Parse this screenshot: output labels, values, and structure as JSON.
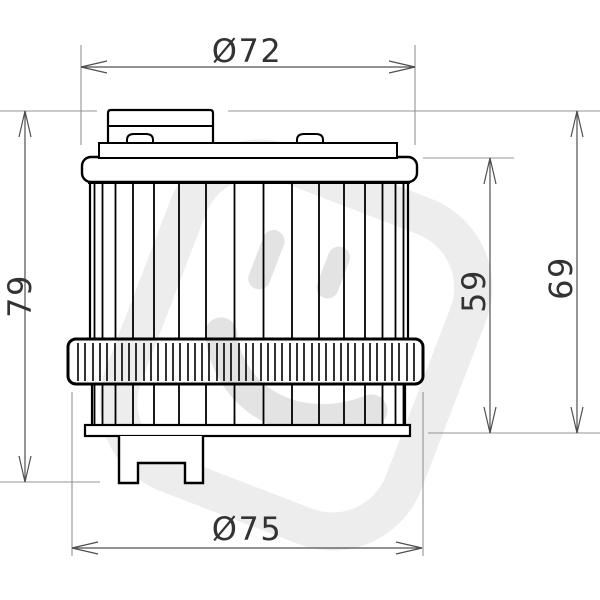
{
  "page": {
    "background": "#ffffff",
    "width": 600,
    "height": 600
  },
  "drawing": {
    "type": "technical-dimension-drawing",
    "subject": "oil filter cartridge - side elevation",
    "labels": {
      "top_diameter": "Ø72",
      "overall_height": "79",
      "element_height": "59",
      "housing_height": "69",
      "nut_diameter": "Ø75"
    },
    "watermark": {
      "name": "smiley-logo-watermark",
      "outline_color": "#ededed",
      "face_color": "#e3e3e3"
    },
    "colors": {
      "outline": "#000000",
      "dimension_line": "#4f4f4f",
      "extension_line": "#949494",
      "dimension_text": "#333333"
    }
  }
}
